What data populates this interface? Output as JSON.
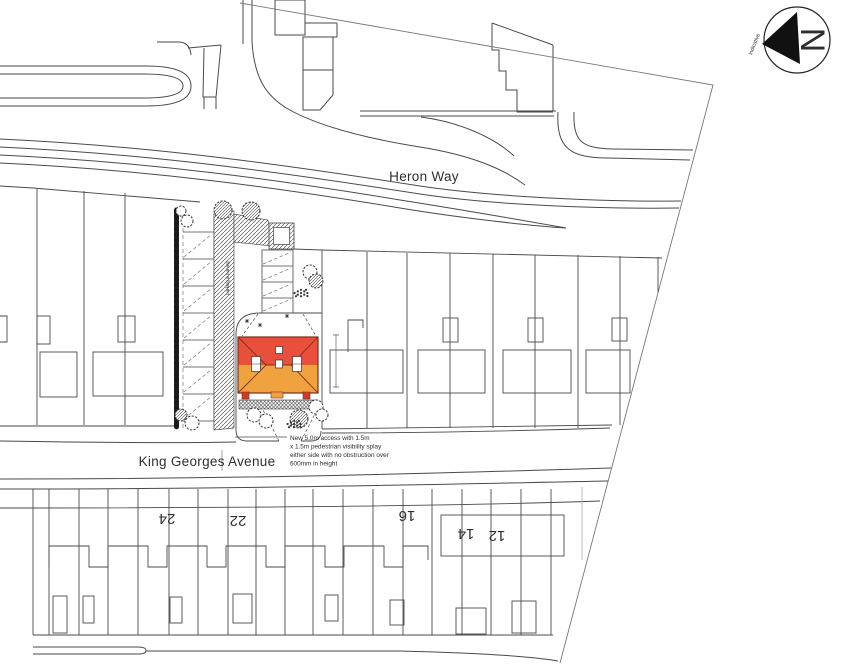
{
  "streets": {
    "heron_way": "Heron Way",
    "king_georges_avenue": "King Georges Avenue"
  },
  "north_arrow": {
    "letter": "N",
    "note": "indicative"
  },
  "site": {
    "parking_area_label": "parking & turning"
  },
  "access_note": {
    "lines": [
      "New 5.0m access with 1.5m",
      "x 1.5m pedestrian visibility splay",
      "either side with no obstruction over",
      "600mm in height"
    ]
  },
  "house_numbers": [
    "24",
    "22",
    "16",
    "14",
    "12"
  ],
  "colors": {
    "roof_front": "#e8503c",
    "roof_rear": "#f0a23f",
    "porch_pillar": "#d23a26",
    "canopy": "#f0a23f",
    "line": "#3c3c3c"
  }
}
